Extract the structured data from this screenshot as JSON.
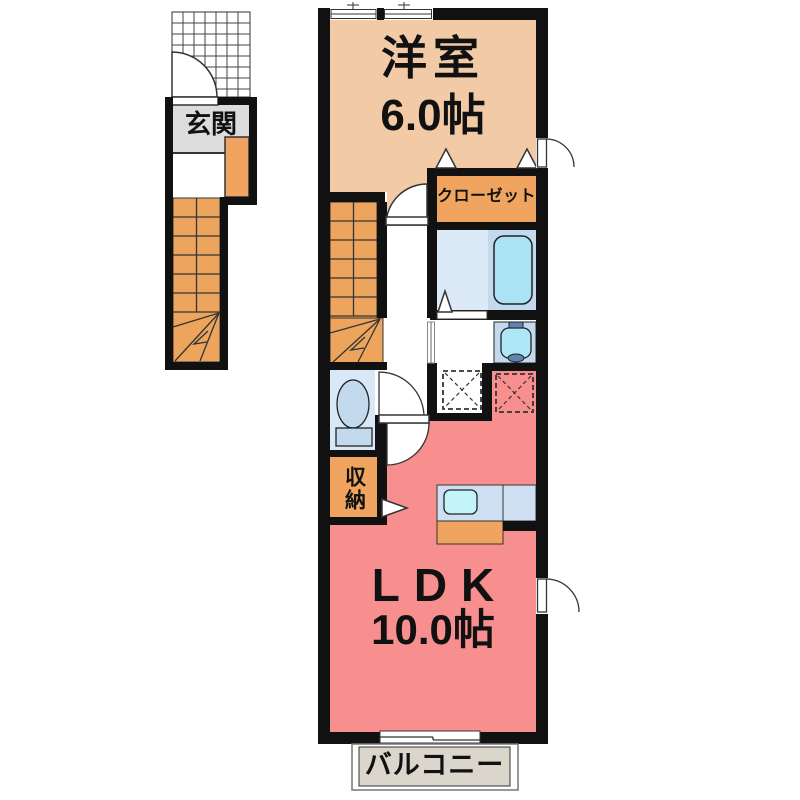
{
  "floor_plan": {
    "type": "japanese-apartment-floor-plan",
    "labels": {
      "western_room": "洋室",
      "western_room_size": "6.0帖",
      "closet": "クローゼット",
      "entrance": "玄関",
      "storage": "収納",
      "ldk": "LDK",
      "ldk_size": "10.0帖",
      "balcony": "バルコニー"
    },
    "colors": {
      "wall": "#111111",
      "western_room_floor": "#f2cba6",
      "ldk_floor": "#f88f8f",
      "closet_fill": "#f0a45f",
      "storage_fill": "#f0a45f",
      "stairs_fill": "#eda55e",
      "entrance_floor": "#dcdcdc",
      "cabinet_fill": "#f0a45f",
      "wet_room_floor": "#dce9f6",
      "toilet_room_floor": "#d9e8f8",
      "fixture_panel": "#c2d9ee",
      "bathtub_fill": "#abe3f5",
      "washbasin_fill": "#aee7f8",
      "kitchen_counter": "#cfdff2",
      "kitchen_sink": "#c2f4fa",
      "balcony_floor": "#dbd6cc",
      "faucet": "#5b84b0"
    }
  }
}
